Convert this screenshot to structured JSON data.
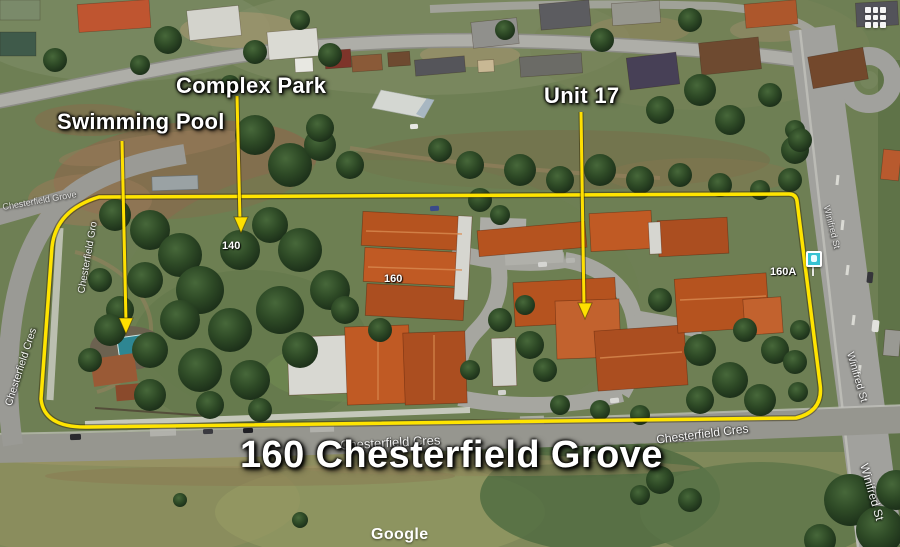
{
  "annotations": {
    "title": "160 Chesterfield Grove",
    "callouts": [
      {
        "id": "swimming-pool",
        "label": "Swimming Pool"
      },
      {
        "id": "complex-park",
        "label": "Complex Park"
      },
      {
        "id": "unit-17",
        "label": "Unit 17"
      }
    ],
    "colors": {
      "highlight": "#ffe400",
      "label_text": "#ffffff"
    }
  },
  "map_labels": {
    "street_names": [
      {
        "text": "Chesterfield Grove"
      },
      {
        "text": "Chesterfield Gro"
      },
      {
        "text": "Chesterfield Cres"
      },
      {
        "text": "Chesterfield Cres"
      },
      {
        "text": "Chesterfield Cres"
      },
      {
        "text": "Winifred St"
      },
      {
        "text": "Winifred St"
      },
      {
        "text": "Winifred St"
      }
    ],
    "house_numbers": [
      {
        "text": "140"
      },
      {
        "text": "160"
      },
      {
        "text": "160A"
      }
    ]
  },
  "icons": [
    {
      "name": "apps-grid-icon"
    },
    {
      "name": "bus-stop-icon"
    }
  ],
  "watermark": {
    "text": "Google"
  }
}
